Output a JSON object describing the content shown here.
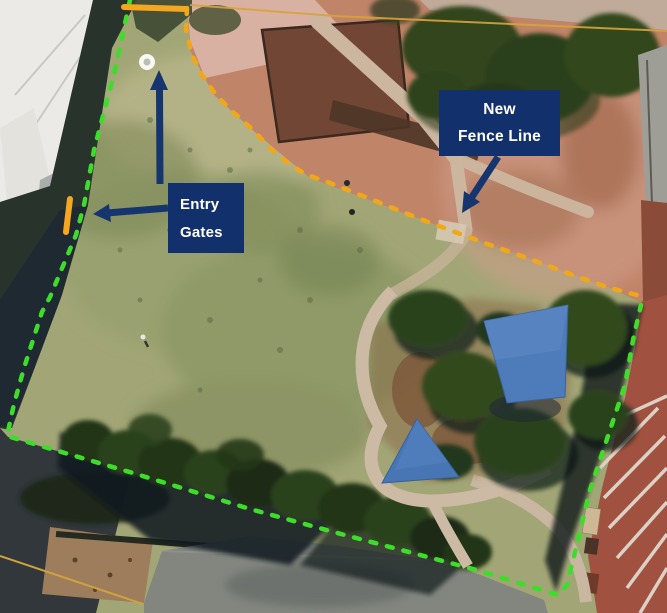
{
  "labels": {
    "entry_gates": {
      "lines": [
        "Entry",
        "Gates"
      ]
    },
    "new_fence": {
      "lines": [
        "New",
        "Fence Line"
      ]
    }
  },
  "colors": {
    "label_background": "#12306b",
    "label_text": "#ffffff",
    "arrow": "#16356f",
    "existing_fence": "#3fdd2b",
    "new_fence": "#f0a818",
    "gate": "#f5a81f",
    "gate_marker": "#fdfdfa"
  }
}
